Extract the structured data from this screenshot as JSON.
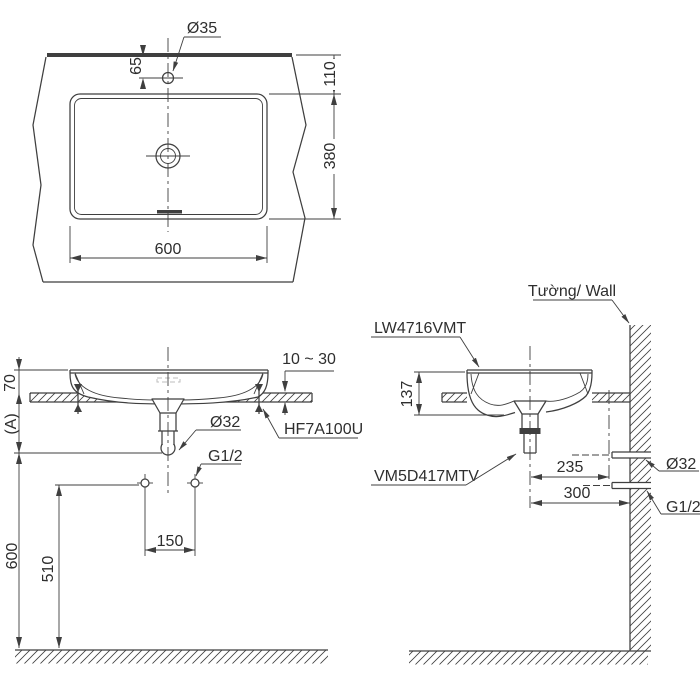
{
  "drawing_type": "basin installation dimension drawing",
  "views": {
    "plan": {
      "hole_dia": "Ø35",
      "hole_offset": "65",
      "edge_offset": "110",
      "depth": "380",
      "width": "600"
    },
    "front": {
      "rim_height": "70",
      "dim_a": "(A)",
      "counter_thickness": "10 ~ 30",
      "drain_dia": "Ø32",
      "bracket_code": "HF7A100U",
      "supply_thread": "G1/2",
      "faucet_pitch": "150",
      "supply_height": "510",
      "drain_height": "600"
    },
    "side": {
      "wall_label": "Tường/ Wall",
      "basin_code": "LW4716VMT",
      "basin_height": "137",
      "trap_code": "VM5D417MTV",
      "drain_to_ref": "235",
      "center_to_wall": "300",
      "wall_drain_dia": "Ø32",
      "wall_supply_thread": "G1/2"
    }
  },
  "colors": {
    "line": "#3f3f3f",
    "text": "#2e2e2e",
    "background": "#ffffff"
  }
}
